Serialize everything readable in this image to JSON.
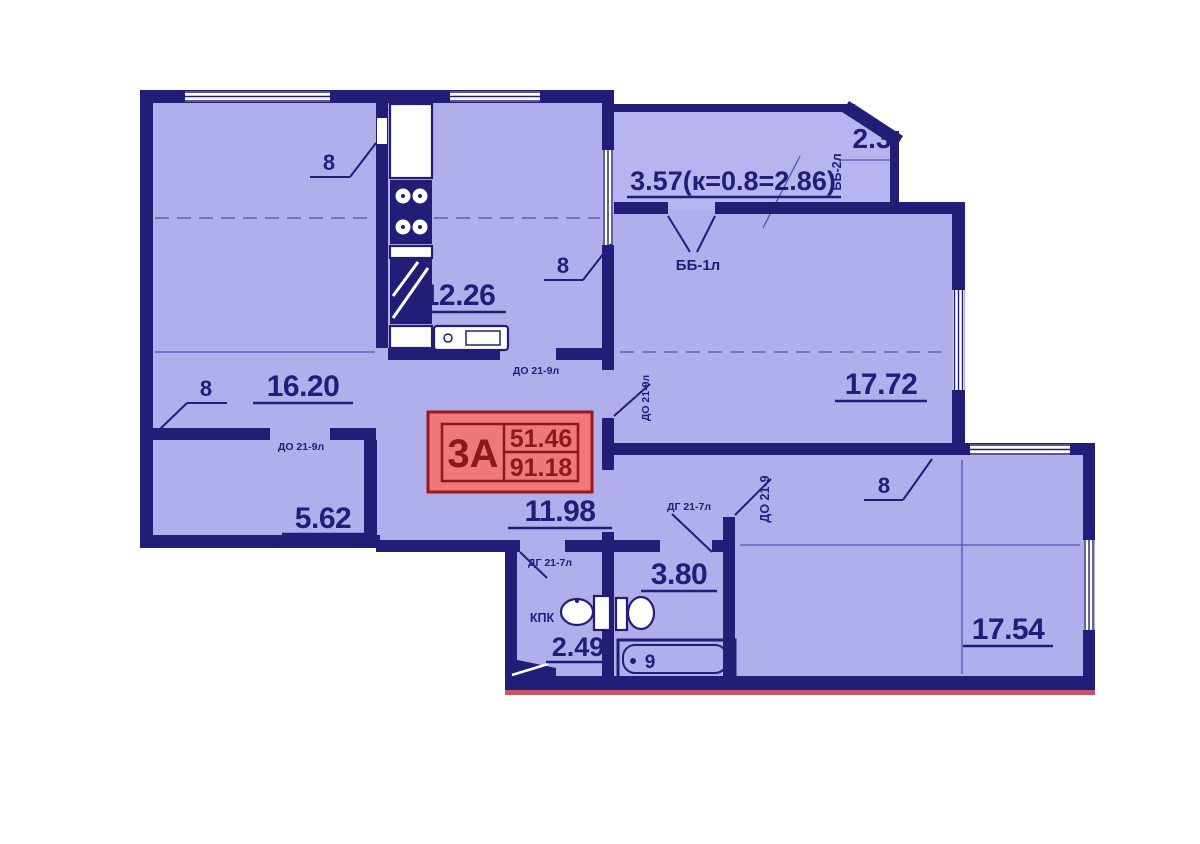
{
  "plan_title": "apartment-floor-plan",
  "colors": {
    "wall": "#221e78",
    "room_fill": "#b1aeec",
    "tag_fill": "#f17878",
    "tag_border": "#9c1a1a",
    "tag_text": "#8e1717",
    "baseline_red": "#c4556a"
  },
  "unit_tag": {
    "flat_type": "3А",
    "living_area": "51.46",
    "total_area": "91.18"
  },
  "rooms": [
    {
      "name": "bedroom-1",
      "area": "16.20"
    },
    {
      "name": "kitchen",
      "area": "12.26"
    },
    {
      "name": "living-room",
      "area": "17.72"
    },
    {
      "name": "corridor",
      "area": "5.62"
    },
    {
      "name": "hall",
      "area": "11.98"
    },
    {
      "name": "bathroom",
      "area": "3.80"
    },
    {
      "name": "laundry",
      "area": "2.49"
    },
    {
      "name": "bedroom-2",
      "area": "17.54"
    },
    {
      "name": "balcony",
      "area": "2.3"
    },
    {
      "name": "loggia",
      "area": "3.57(к=0.8=2.86)"
    }
  ],
  "joinery_labels": [
    {
      "code": "ДО 21-9л"
    },
    {
      "code": "ДО 21-9л"
    },
    {
      "code": "ДО 21-9л"
    },
    {
      "code": "ДО 21-9"
    },
    {
      "code": "ДГ 21-7л"
    },
    {
      "code": "ДГ 21-7л"
    },
    {
      "code": "ББ-1л"
    },
    {
      "code": "ББ-2л"
    },
    {
      "code": "КПК"
    }
  ],
  "window_marks": [
    "8",
    "8",
    "8",
    "8"
  ],
  "fixture_marks": [
    "9"
  ]
}
